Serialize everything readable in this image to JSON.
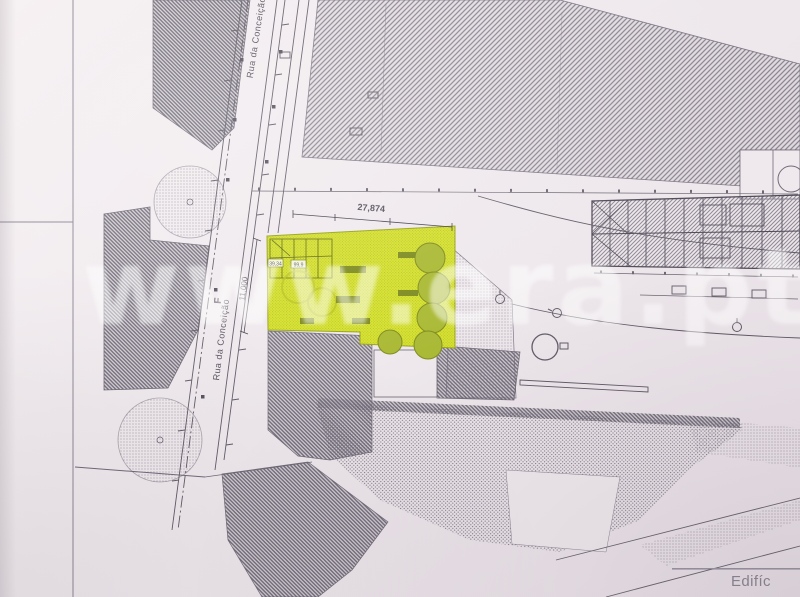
{
  "plan": {
    "street": {
      "name": "Rua da Conceição",
      "width_dimension": "11,000",
      "hydrant_marker": "F"
    },
    "parcel": {
      "front_dimension": "27,874",
      "area_label_1": "39,34",
      "area_label_2": "99,9"
    },
    "watermark": "www.era.pt",
    "title_block": {
      "caption": "Edifíc"
    }
  }
}
